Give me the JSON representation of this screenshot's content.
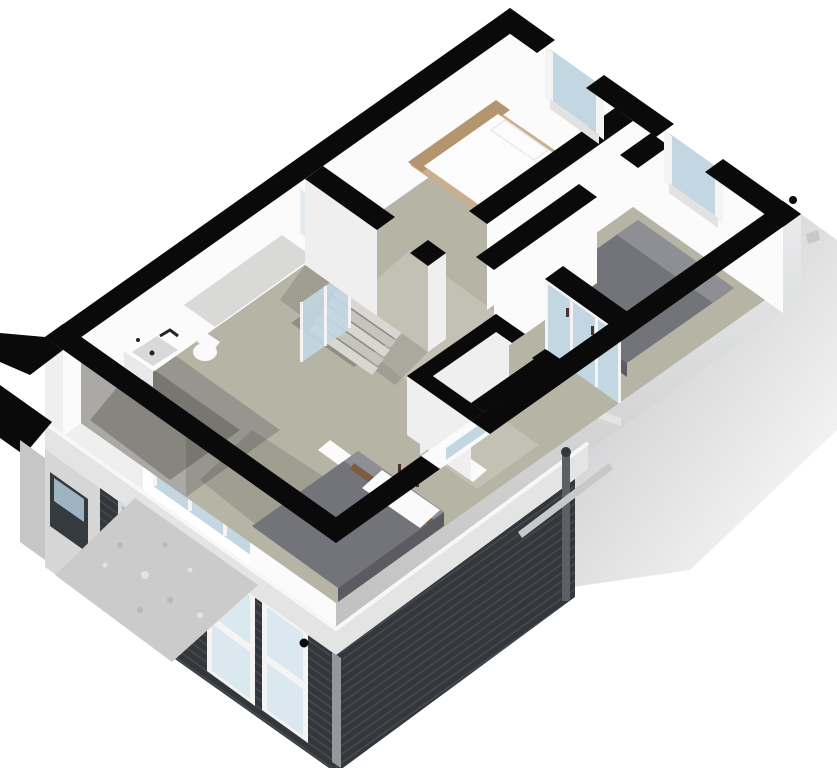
{
  "scene": {
    "kind": "3d-isometric-floorplan-render",
    "view": "axonometric cutaway of upper storey over dark-clad lower storey",
    "elements": [
      "exterior-walls-black-tops",
      "north-bedroom-white-bed",
      "wood-bed-rim",
      "dark-textured-rug",
      "east-bedroom-gray-bed",
      "closet-glass-sliding-doors",
      "stairwell",
      "west-bathroom-sink",
      "toilet",
      "small-bathroom",
      "southwest-bedroom-gray-bed",
      "glass-partitions",
      "lower-storey-dark-siding",
      "siding-windows",
      "fascia-band",
      "downspout",
      "gutter-rail",
      "driveway-slab",
      "roof-vent-dot"
    ]
  },
  "palette": {
    "bg": "#ffffff",
    "wallTop": "#0a0a0a",
    "faceLit": "#fbfbfb",
    "faceSoft": "#efefef",
    "faceShade": "#d9d9d9",
    "faceDim": "#c0c0c0",
    "floorMain": "#b6b4a5",
    "floorHall": "#c3c1b4",
    "floorBath": "#96958e",
    "bathWall": "#aba9a5",
    "shadow": "rgba(45,45,35,0.16)",
    "shadowDeep": "rgba(30,30,25,0.26)",
    "glass": "#c3d7e3",
    "glassLight": "#dce8f0",
    "glassDim": "#9fb4c2",
    "frameWhite": "#f4f4f4",
    "sidingDark": "#33373b",
    "sidingLine": "#454a4f",
    "fascia": "#e4e4e4",
    "fasciaHi": "#f7f7f7",
    "lowerWhite": "#d6d6d6",
    "lowerGray": "#c6c6c6",
    "seFace": "#e9eaeb",
    "wedgeA": "#bfc0c2",
    "wedgeB": "#ffffff",
    "bedWhite": "#fcfcfc",
    "bedWhiteShade": "#e9e9e9",
    "headboardWood": "#c9b08d",
    "headboardInner": "#b3966f",
    "rug": "#241d14",
    "rugFleck": "#4a3b28",
    "bedGray": "#73737a",
    "bedGrayLight": "#8e8e95",
    "bedGraySide": "#5b5b61",
    "woodBase": "#7d5c40",
    "stairLight": "#d9d8d0",
    "stairMid": "#c6c5bc",
    "stairWell": "#8f8e84",
    "fixture": "#fafafa",
    "stem": "#4a332c",
    "sill": "#e2e2e2",
    "windowHole": "#343a3e",
    "pipe": "#5c6064",
    "rail": "#c8c8c8",
    "trim": "#95989b",
    "dot": "#0b0b0b",
    "driveway": "#cbcbcb",
    "speckleA": "#b9b9b9",
    "speckleB": "#e3e3e3",
    "nightstand": "#97979b",
    "faucet": "#222222"
  }
}
